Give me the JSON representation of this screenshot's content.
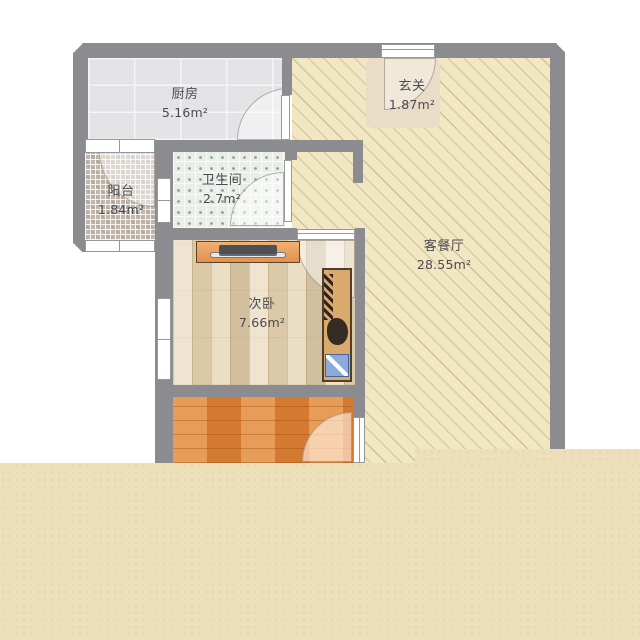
{
  "plan": {
    "title": "apartment-floor-plan",
    "rooms": [
      {
        "id": "kitchen",
        "name": "厨房",
        "area": "5.16m²"
      },
      {
        "id": "hallway",
        "name": "玄关",
        "area": "1.87m²"
      },
      {
        "id": "balcony",
        "name": "阳台",
        "area": "1.84m²"
      },
      {
        "id": "bathroom",
        "name": "卫生间",
        "area": "2.7m²"
      },
      {
        "id": "bedroom2",
        "name": "次卧",
        "area": "7.66m²"
      },
      {
        "id": "living_dining",
        "name": "客餐厅",
        "area": "28.55m²"
      }
    ],
    "colors": {
      "wall": "#8c8c90",
      "page_background": "#ffffff",
      "bottom_mask": "#ecdfba",
      "living_floor": "#f2e7c3",
      "kitchen_floor": "#e3e3e6",
      "bathroom_floor": "#e9eee9",
      "balcony_floor": "#c1b7ab",
      "bedroom_floor": "#e7d9bc",
      "orange_room_floor": "#e0873a",
      "desk": "#ea9e58",
      "wardrobe": "#d9aa6c",
      "wardrobe_drawer": "#8cabdc",
      "label_text": "#4b4b50"
    }
  }
}
